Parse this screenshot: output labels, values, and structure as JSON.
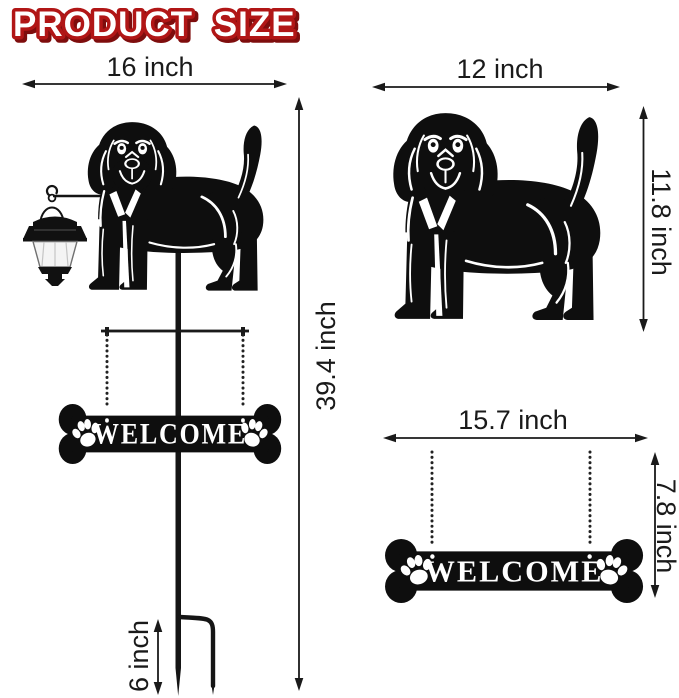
{
  "title": "PRODUCT SIZE",
  "colors": {
    "background": "#ffffff",
    "title_fill": "#ffffff",
    "title_outline": "#b11616",
    "title_shadow": "#7e0d0d",
    "dimension_ink": "#1a1a1a",
    "silhouette": "#0e0e0e",
    "lantern_glass": "#f4f4f4"
  },
  "left_figure": {
    "description": "full dog garden stake with solar lantern and hanging bone sign",
    "width_label": "16 inch",
    "height_label": "39.4 inch",
    "stake_depth_label": "6 inch",
    "sign_text": "WELCOME"
  },
  "right_top_figure": {
    "description": "dog silhouette only",
    "width_label": "12 inch",
    "height_label": "11.8 inch"
  },
  "right_bottom_figure": {
    "description": "bone welcome sign only",
    "width_label": "15.7 inch",
    "height_label": "7.8 inch",
    "sign_text": "WELCOME"
  }
}
